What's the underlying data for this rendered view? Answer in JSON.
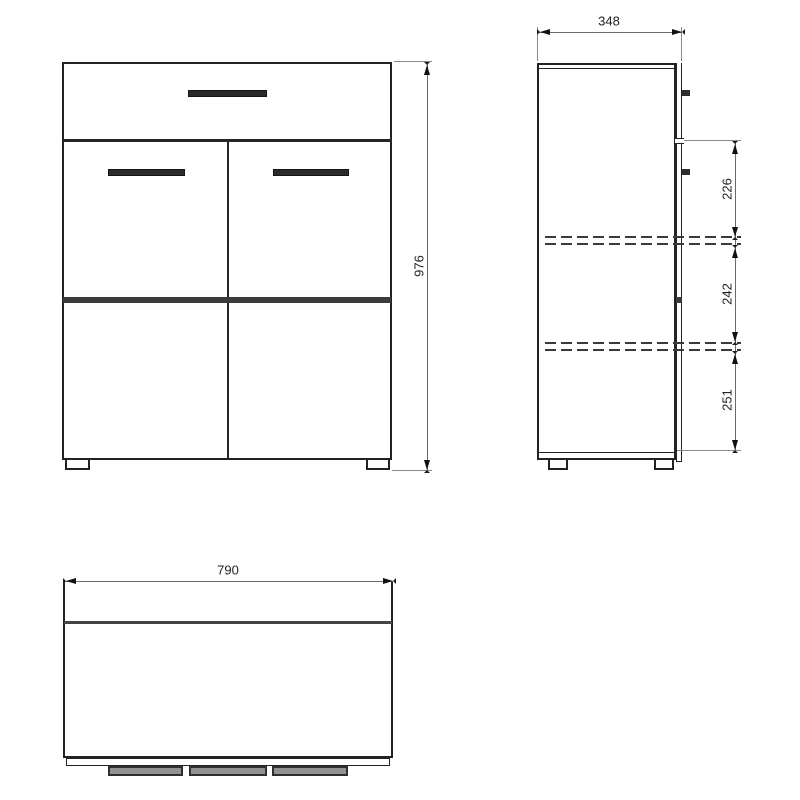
{
  "drawing": {
    "type": "furniture-technical-drawing",
    "subject": "two-door cabinet with drawer, three orthographic views",
    "views": {
      "front": {
        "dim_height": {
          "value": "976"
        }
      },
      "side": {
        "dim_depth": {
          "value": "348"
        },
        "dim_sections": [
          {
            "value": "226"
          },
          {
            "value": "242"
          },
          {
            "value": "251"
          }
        ]
      },
      "top": {
        "dim_width": {
          "value": "790"
        }
      }
    },
    "colors": {
      "background": "#ffffff",
      "outline": "#222222",
      "dimension_line": "#6a6a6a",
      "arrow": "#111111",
      "handle": "#2b2b2b",
      "accent_band": "#3b3b3b",
      "shelf_dash": "#3a3a3a",
      "text": "#1f1f1f"
    }
  }
}
